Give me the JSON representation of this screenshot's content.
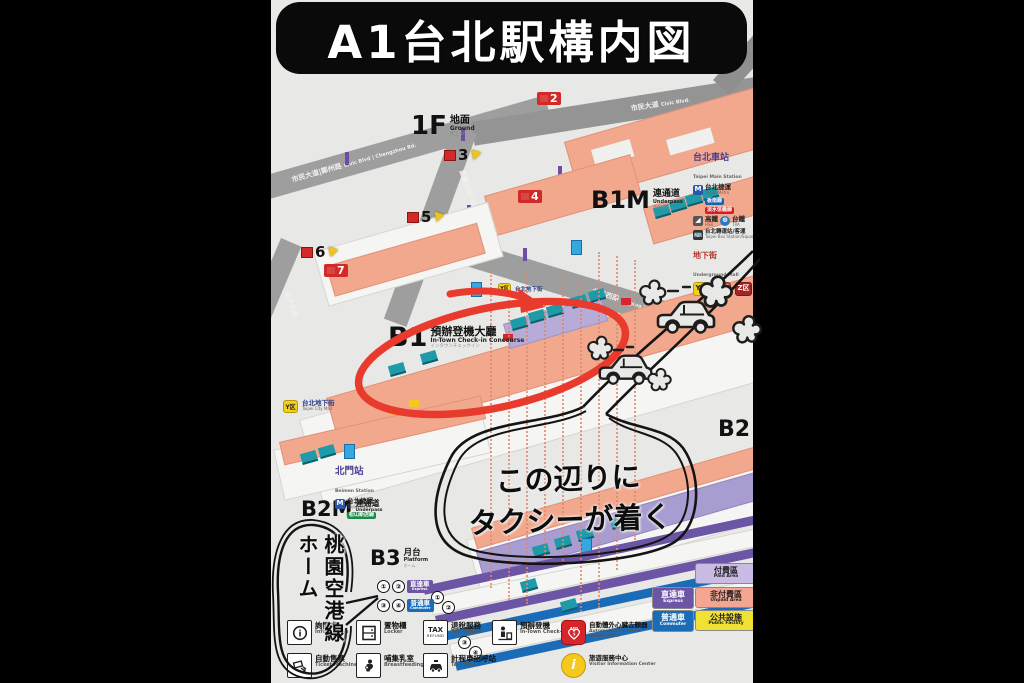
{
  "title": "A1台北駅構内図",
  "floors": {
    "f1": {
      "code": "1F",
      "cjk": "地面",
      "en": "Ground",
      "tiny": "地上 1F"
    },
    "b1m": {
      "code": "B1M",
      "cjk": "連通道",
      "en": "Underpass",
      "tiny": "連絡通路"
    },
    "b1": {
      "code": "B1",
      "cjk": "預辦登機大廳",
      "en": "In-Town Check-in Concourse",
      "tiny": "インタウンチェックイン"
    },
    "b2": {
      "code": "B2",
      "cjk": "大廳",
      "en": "Concourse",
      "tiny": "コンコース"
    },
    "b2m": {
      "code": "B2M",
      "cjk": "連通道",
      "en": "Underpass",
      "tiny": "連絡通路"
    },
    "b3": {
      "code": "B3",
      "cjk": "月台",
      "en": "Platform",
      "tiny": "ホーム"
    }
  },
  "annotations": {
    "taxi_line1": "この辺りに",
    "taxi_line2": "タクシーが着く",
    "platform_line1": "桃園空港線",
    "platform_line2": "ホーム"
  },
  "station_legend": {
    "title_cjk": "台北車站",
    "title_en": "Taipei Main Station",
    "metro_cjk": "台北捷運",
    "metro_en": "Taipei Metro",
    "line_blue": "板南線",
    "line_red": "淡水信義線",
    "hsr_cjk": "高鐵",
    "hsr_en": "HSR",
    "tra_cjk": "台鐵",
    "tra_en": "TRA",
    "bus_cjk": "台北轉運站/客運",
    "bus_en": "Taipei Bus Station/Square",
    "mall_cjk": "地下街",
    "mall_en": "Underground Mall",
    "zones": [
      "Y区",
      "K区",
      "Z区"
    ]
  },
  "beimen": {
    "cjk": "北門站",
    "en": "Beimen Station",
    "metro_cjk": "台北捷運",
    "metro_en": "Taipei Metro",
    "line": "松山新店線"
  },
  "citymall": {
    "zone": "Y区",
    "cjk": "台北地下街",
    "en": "Taipei City Mall"
  },
  "citymall_b1": "台北地下街",
  "roads": [
    {
      "cjk": "市民大道|鄭州路",
      "en": "Civic Blvd | Chengzhou Rd."
    },
    {
      "cjk": "重慶北路一段",
      "en": "Chongqing N. Rd. Sec.1"
    },
    {
      "cjk": "北平西路",
      "en": "Beiping W. Rd."
    },
    {
      "cjk": "延平北路",
      "en": "Yanping N. Rd."
    },
    {
      "cjk": "市民大道",
      "en": "Civic Blvd."
    }
  ],
  "exits": [
    {
      "n": "2"
    },
    {
      "n": "3"
    },
    {
      "n": "4"
    },
    {
      "n": "5"
    },
    {
      "n": "6"
    },
    {
      "n": "7"
    }
  ],
  "platforms": {
    "nums": [
      "①",
      "②",
      "③",
      "④"
    ],
    "express_cjk": "直達車",
    "express_en": "Express",
    "commuter_cjk": "普通車",
    "commuter_en": "Commuter"
  },
  "areas": {
    "paid": {
      "cjk": "付費區",
      "en": "Paid Area",
      "color": "#c9bbe4"
    },
    "unpaid": {
      "cjk": "非付費區",
      "en": "Unpaid Area",
      "color": "#f4a692"
    },
    "public": {
      "cjk": "公共設施",
      "en": "Public Facility",
      "color": "#f1e132"
    },
    "express": {
      "cjk": "直達車",
      "en": "Express",
      "color": "#6b55a4"
    },
    "commuter": {
      "cjk": "普通車",
      "en": "Commuter",
      "color": "#1b6cb8"
    }
  },
  "facilities": [
    {
      "icon": "information-icon",
      "cjk": "詢問處",
      "en": "Information"
    },
    {
      "icon": "locker-icon",
      "cjk": "置物櫃",
      "en": "Locker"
    },
    {
      "icon": "tax-refund-icon",
      "cjk": "退稅服務",
      "en": "Tax Refund"
    },
    {
      "icon": "intown-checkin-icon",
      "cjk": "預辦登機",
      "en": "In-Town Check-in"
    },
    {
      "icon": "aed-icon",
      "cjk": "自動體外心臟去顫器",
      "en": "Automated External Defibrillator"
    },
    {
      "icon": "ticket-machine-icon",
      "cjk": "自動售票",
      "en": "Ticket Machine"
    },
    {
      "icon": "breastfeeding-icon",
      "cjk": "哺集乳室",
      "en": "Breastfeeding Room"
    },
    {
      "icon": "taxi-stand-icon",
      "cjk": "計程車招呼站",
      "en": "Taxi Stand"
    },
    {
      "icon": "visitor-info-icon",
      "cjk": "旅遊服務中心",
      "en": "Visitor Information Center"
    }
  ],
  "tax_icon_text": {
    "line1": "TAX",
    "line2": "REFUND"
  },
  "aed_icon_text": "AED"
}
